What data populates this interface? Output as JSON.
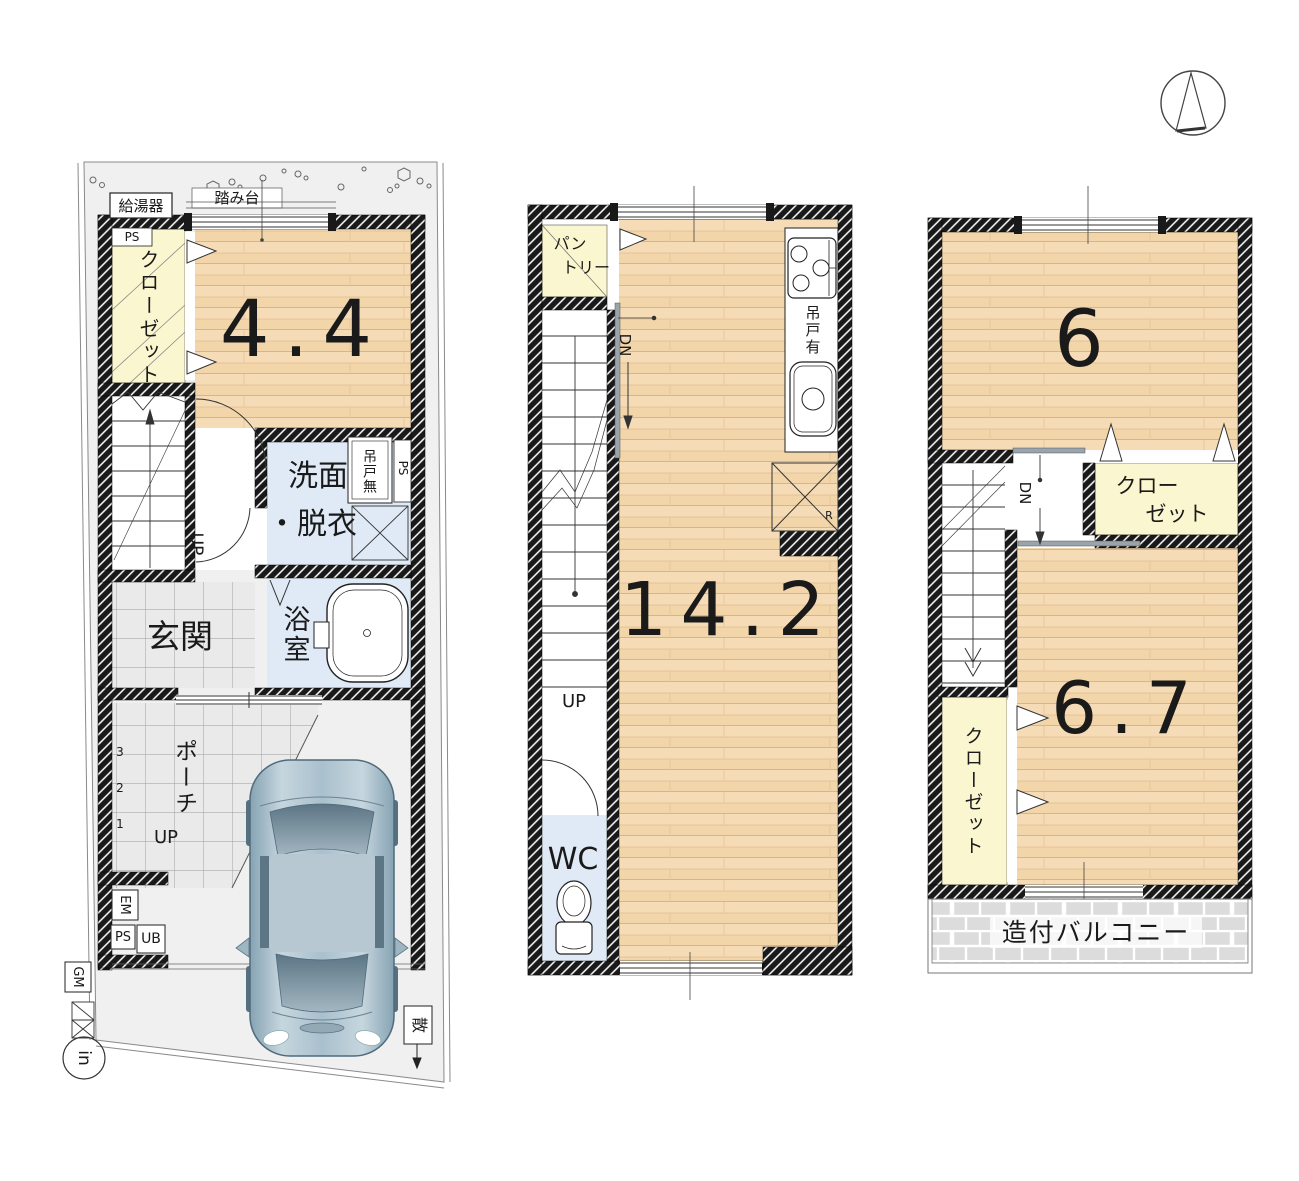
{
  "palette": {
    "wall": "#191919",
    "wood_floor": "#f2d5a8",
    "closet_yellow": "#faf6cf",
    "wet_blue": "#e0eaf6",
    "site_gray": "#f0f0f0",
    "balcony_gray": "#dedede",
    "car_body": "#a9c0cd"
  },
  "floor1": {
    "water_heater": "給湯器",
    "step_stool": "踏み台",
    "ps_closet": "PS",
    "closet": "クローゼット",
    "room_size": "4.4",
    "washroom_line1": "洗面",
    "washroom_line2": "・脱衣",
    "hanging_cupboard_none": "吊戸無",
    "ps_side": "PS",
    "bathroom": "浴室",
    "entrance": "玄関",
    "porch": "ポーチ",
    "stairs_up": "UP",
    "porch_up": "UP",
    "step3": "3",
    "step2": "2",
    "step1": "1",
    "em_meter": "EM",
    "ps_meter": "PS",
    "ub_meter": "UB",
    "gm_meter": "GM",
    "sprinkler": "散",
    "boundary_marker": "in"
  },
  "floor2": {
    "pantry_line1": "パン",
    "pantry_line2": "トリー",
    "stairs_down": "DN",
    "hanging_cupboard_yes": "吊戸有",
    "refrigerator": "R",
    "ldk_size": "14.2",
    "stairs_up": "UP",
    "toilet": "WC"
  },
  "floor3": {
    "room6_size": "6",
    "closet_upper_line1": "クロー",
    "closet_upper_line2": "ゼット",
    "stairs_down": "DN",
    "closet_lower": "クローゼット",
    "room67_size": "6.7",
    "balcony": "造付バルコニー"
  }
}
